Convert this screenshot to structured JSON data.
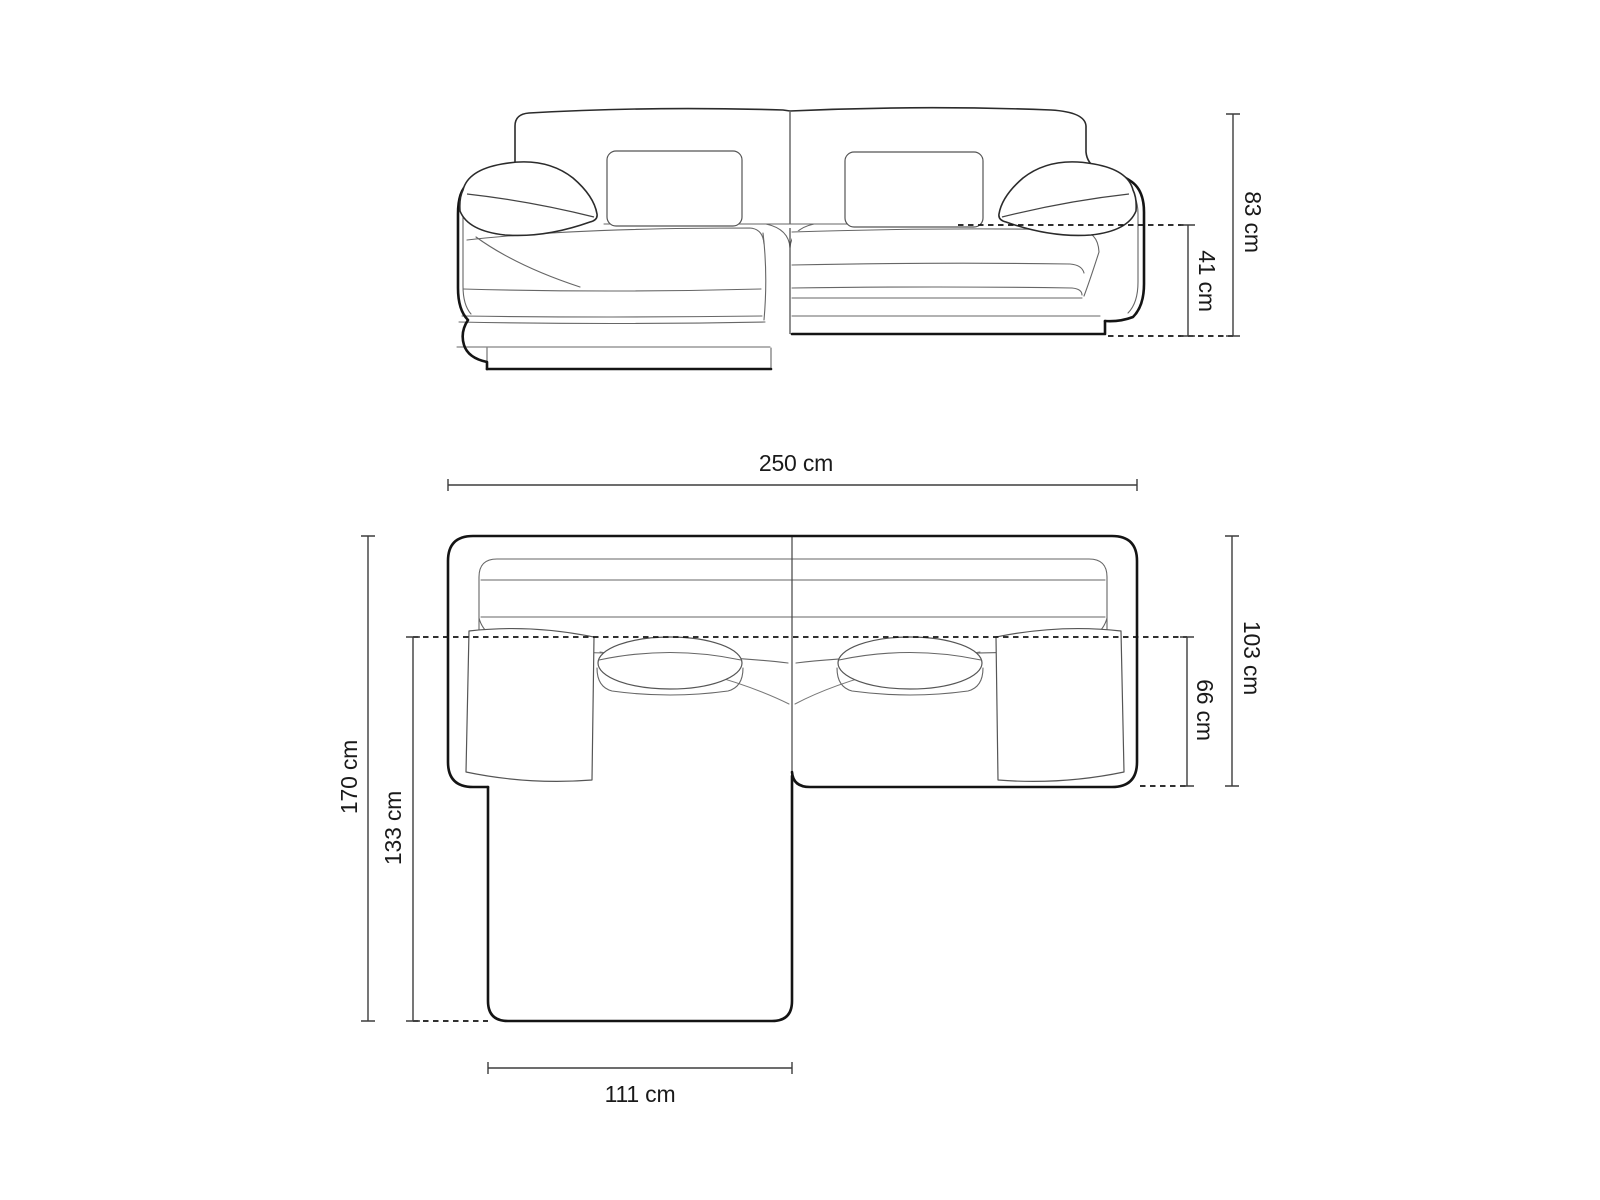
{
  "diagram": {
    "subject": "corner-sofa-dimension-drawing",
    "views": [
      "front-elevation",
      "top-plan"
    ]
  },
  "front_view": {
    "overall_height": "83 cm",
    "seat_height": "41 cm"
  },
  "top_view": {
    "overall_width": "250 cm",
    "overall_depth": "170 cm",
    "chaise_depth": "133 cm",
    "body_depth": "103 cm",
    "seat_depth": "66 cm",
    "chaise_width": "111 cm"
  },
  "colors": {
    "background": "#ffffff",
    "outline": "#141414",
    "detail_line": "#666666",
    "dimension_line": "#3d3d3d",
    "label_text": "#1a1a1a"
  }
}
